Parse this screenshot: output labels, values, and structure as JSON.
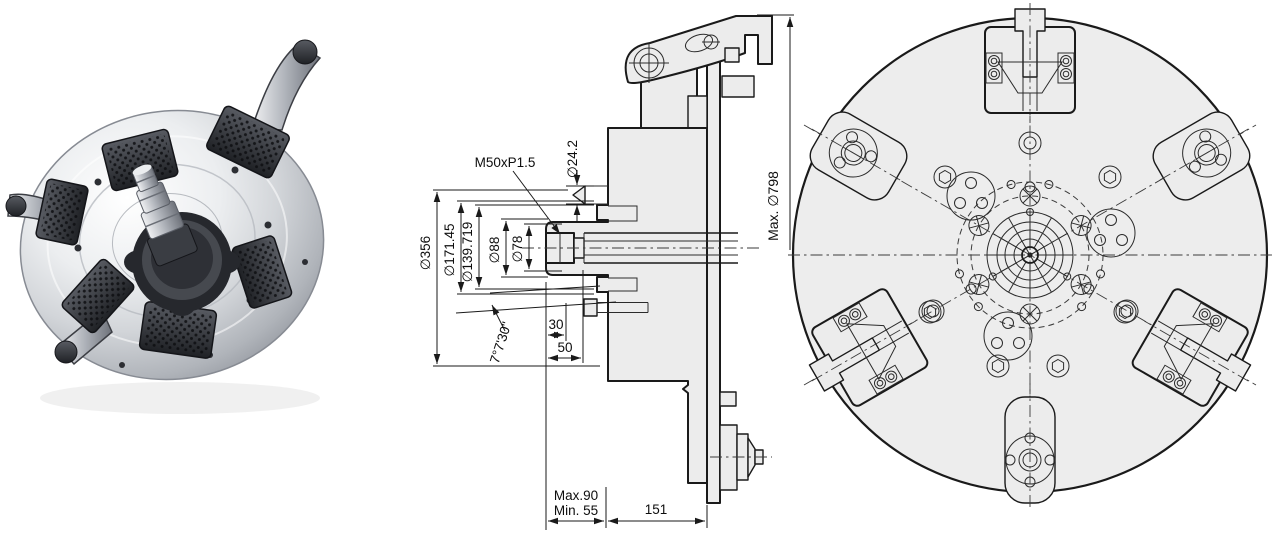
{
  "colors": {
    "background": "#ffffff",
    "drawing_fill": "#ececec",
    "drawing_line": "#1a1a1a",
    "text": "#0d0d0d"
  },
  "section": {
    "thread_label": "M50xP1.5",
    "dia_tip": "∅24.2",
    "dia_body": "∅356",
    "dia_recess_outer": "∅171.45",
    "dia_recess_inner": "∅139.719",
    "dia_hub": "∅88",
    "dia_bore": "∅78",
    "dim_30": "30",
    "dim_50": "50",
    "taper_angle": "7°7'30\"",
    "stroke_max": "Max.90",
    "stroke_min": "Min. 55",
    "dim_151": "151",
    "max_swing": "Max. ∅798"
  }
}
